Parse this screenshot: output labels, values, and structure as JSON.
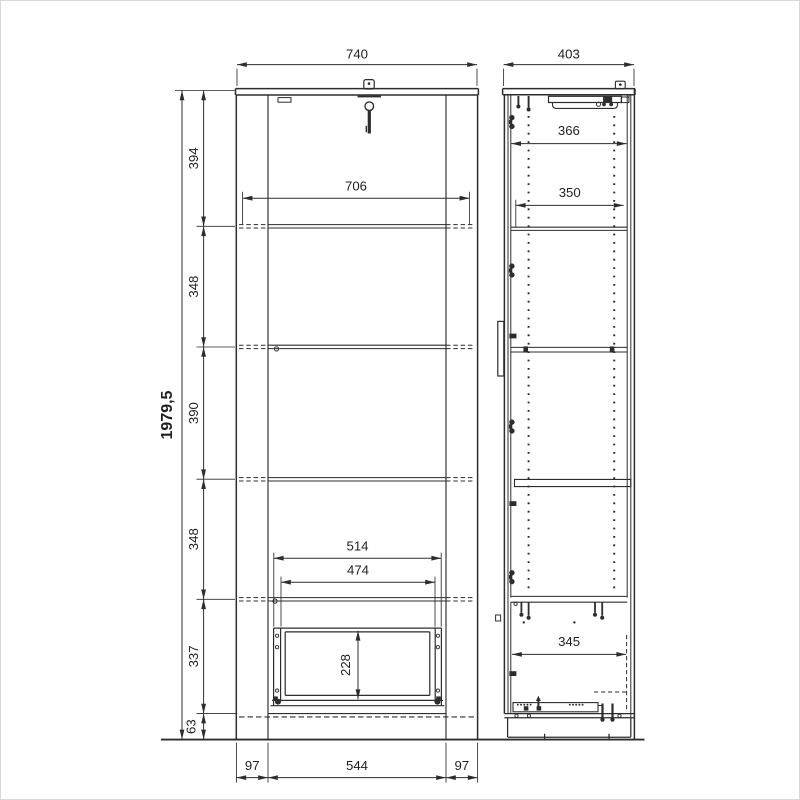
{
  "colors": {
    "background": "#ffffff",
    "line": "#2d2d2d",
    "text": "#1f1f1f",
    "border": "#d9d9d9"
  },
  "dims": {
    "front_width": "740",
    "side_depth": "403",
    "front_inner_width": "706",
    "total_height": "1979,5",
    "seg_top": "394",
    "seg_2": "348",
    "seg_3": "390",
    "seg_4": "348",
    "seg_5": "337",
    "seg_plinth": "63",
    "drawer_outer_width": "514",
    "drawer_inner_width": "474",
    "drawer_front_height": "228",
    "plinth_left": "97",
    "plinth_center": "544",
    "plinth_right": "97",
    "side_inner_depth": "366",
    "side_shelf_depth": "350",
    "side_bottom_depth": "345"
  }
}
